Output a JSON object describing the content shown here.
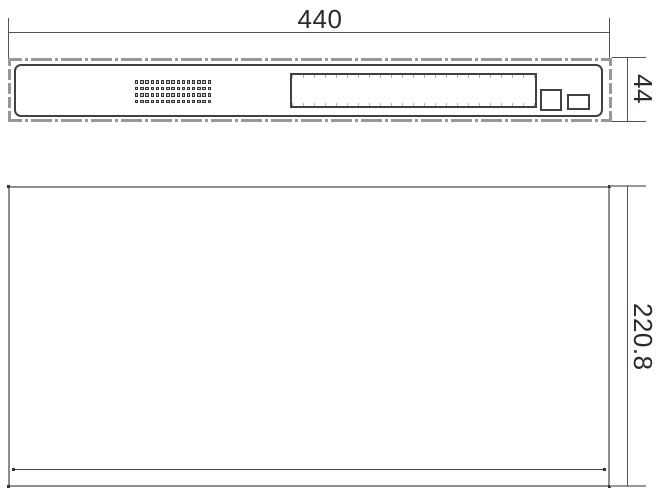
{
  "dimensions": {
    "width_label": "440",
    "height_label": "44",
    "depth_label": "220.8"
  },
  "front_view": {
    "vent_grid": {
      "rows": 4,
      "cols": 15
    }
  },
  "colors": {
    "line_dark": "#46403d",
    "line_gray": "#9a9694",
    "dim_line": "#56514e",
    "text": "#2e2926"
  }
}
